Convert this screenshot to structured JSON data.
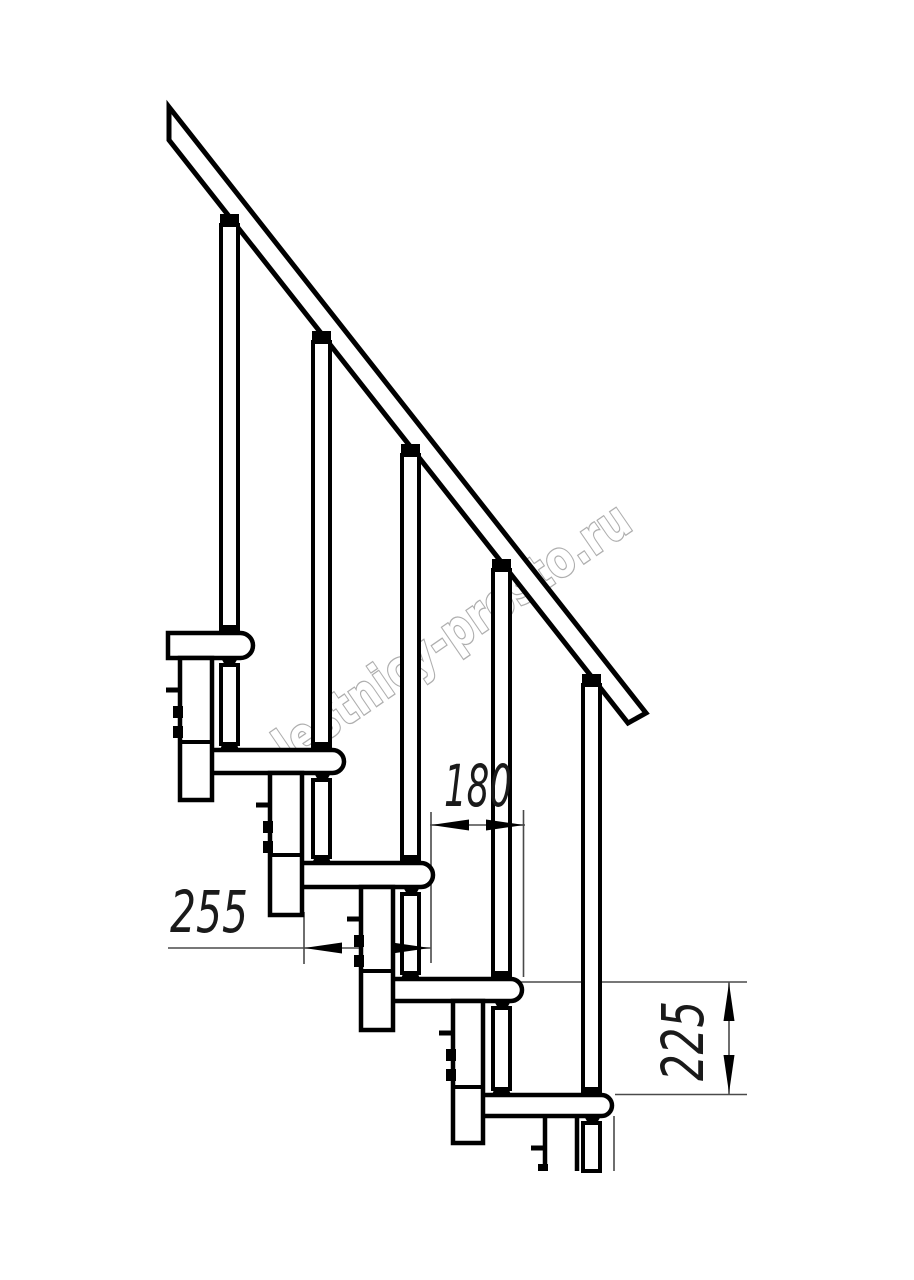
{
  "drawing": {
    "type": "stair-side-elevation",
    "watermark": "lestnicy-prosto.ru",
    "dimensions": {
      "tread_depth": {
        "value": "255"
      },
      "nose_offset": {
        "value": "180"
      },
      "step_rise": {
        "value": "225"
      }
    },
    "colors": {
      "line": "#000000",
      "thin_line": "#4a4a4a",
      "dim_text": "#1a1a1a",
      "watermark": "#a6a6a6",
      "background": "#ffffff"
    }
  }
}
